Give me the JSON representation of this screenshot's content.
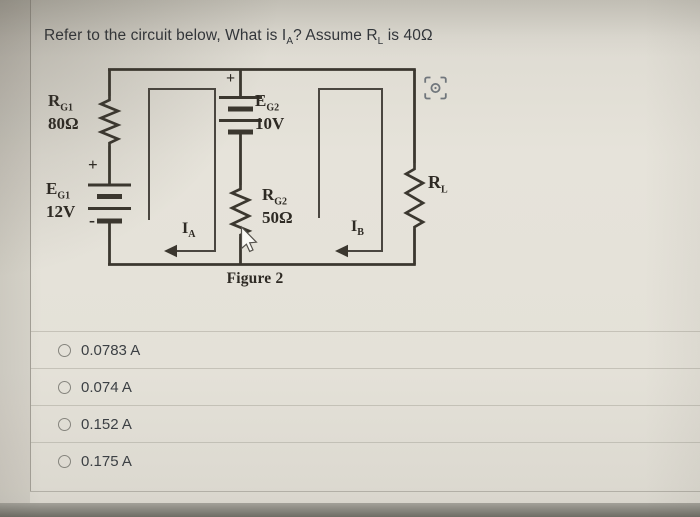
{
  "question": {
    "part1": "Refer to the circuit below, What is I",
    "sub1": "A",
    "part2": "? Assume R",
    "sub2": "L",
    "part3": " is 40Ω"
  },
  "circuit": {
    "caption": "Figure 2",
    "labels": {
      "rg1_base": "R",
      "rg1_sub": "G1",
      "rg1_value": "80Ω",
      "eg1_base": "E",
      "eg1_sub": "G1",
      "eg1_value": "12V",
      "eg2_base": "E",
      "eg2_sub": "G2",
      "eg2_value": "10V",
      "rg2_base": "R",
      "rg2_sub": "G2",
      "rg2_value": "50Ω",
      "rl_base": "R",
      "rl_sub": "L",
      "ia_base": "I",
      "ia_sub": "A",
      "ib_base": "I",
      "ib_sub": "B",
      "plus_left": "+",
      "minus_left": "-",
      "plus_mid": "+"
    }
  },
  "options": [
    {
      "label": "0.0783 A"
    },
    {
      "label": "0.074 A"
    },
    {
      "label": "0.152 A"
    },
    {
      "label": "0.175 A"
    }
  ],
  "icons": {
    "viewfinder": "focus-viewfinder-icon",
    "cursor": "mouse-cursor-icon"
  },
  "colors": {
    "wire": "#3b372f",
    "loop": "#4a4640",
    "background": "#e4e1d8",
    "bottom_bezel": "#75746c",
    "icon_gray": "#5d646d"
  }
}
